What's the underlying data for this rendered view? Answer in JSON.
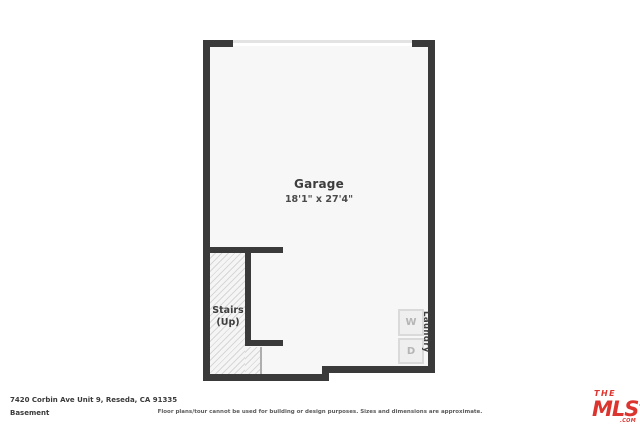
{
  "plan": {
    "garage": {
      "name": "Garage",
      "dimensions": "18'1\" x 27'4\""
    },
    "stairs": {
      "line1": "Stairs",
      "line2": "(Up)"
    },
    "laundry": {
      "washer": "W",
      "dryer": "D",
      "label": "Laundry"
    }
  },
  "footer": {
    "address": "7420 Corbin Ave Unit 9, Reseda, CA 91335",
    "level": "Basement",
    "disclaimer": "Floor plans/tour cannot be used for building or design purposes. Sizes and dimensions are approximate."
  },
  "logo": {
    "the": "THE",
    "mls": "MLS",
    "tm": "™",
    "com": ".COM"
  },
  "colors": {
    "wall": "#3a3a3a",
    "interior": "#f7f7f7",
    "hatch_line": "#d7d7d7",
    "logo_red": "#dc3530",
    "door_line": "#e3e3e3"
  }
}
